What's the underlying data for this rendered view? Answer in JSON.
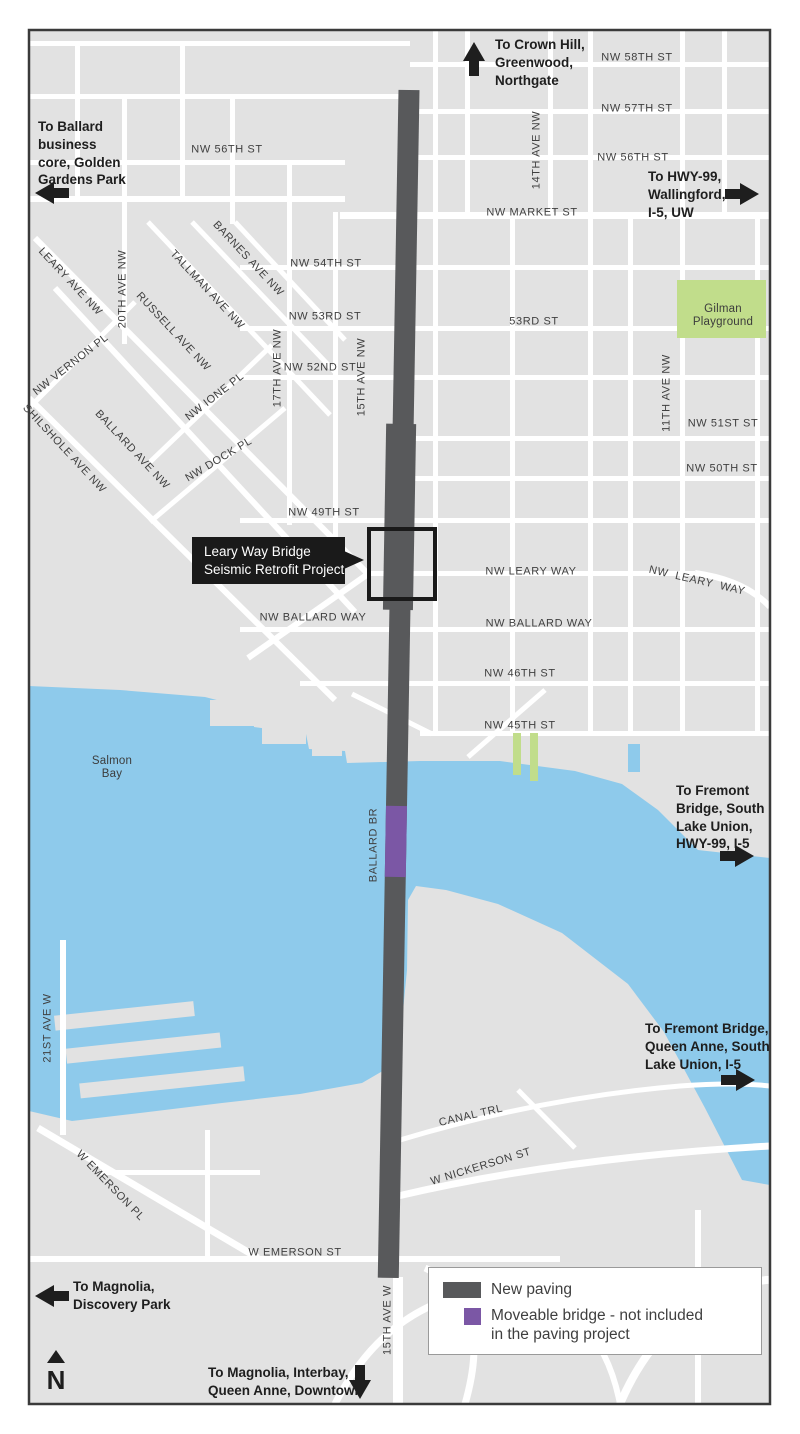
{
  "colors": {
    "land": "#e2e2e2",
    "street": "#ffffff",
    "water": "#8ecaeb",
    "park": "#c1dd8b",
    "paving": "#58595b",
    "moveable_bridge": "#7b57a5"
  },
  "callout": {
    "text": "Leary Way Bridge\nSeismic Retrofit Project"
  },
  "compass": {
    "label": "N"
  },
  "legend": {
    "items": [
      {
        "label": "New paving",
        "color": "#58595b"
      },
      {
        "label": "Moveable bridge - not included\nin the paving project",
        "color": "#7b57a5"
      }
    ]
  },
  "direction_signs": [
    {
      "text": "To Crown Hill,\nGreenwood,\nNorthgate",
      "tx": 495,
      "ty": 36,
      "arrow": {
        "dir": "up",
        "x": 474,
        "y": 59
      }
    },
    {
      "text": "To Ballard\nbusiness\ncore, Golden\nGardens Park",
      "tx": 38,
      "ty": 118,
      "arrow": {
        "dir": "left",
        "x": 52,
        "y": 193
      }
    },
    {
      "text": "To HWY-99,\nWallingford,\nI-5, UW",
      "tx": 648,
      "ty": 168,
      "arrow": {
        "dir": "right",
        "x": 742,
        "y": 194
      }
    },
    {
      "text": "To Fremont\nBridge, South\nLake Union,\nHWY-99, I-5",
      "tx": 676,
      "ty": 782,
      "arrow": {
        "dir": "right",
        "x": 737,
        "y": 856
      }
    },
    {
      "text": "To Fremont Bridge,\nQueen Anne, South\nLake Union, I-5",
      "tx": 645,
      "ty": 1020,
      "arrow": {
        "dir": "right",
        "x": 738,
        "y": 1080
      }
    },
    {
      "text": "To Magnolia,\nDiscovery Park",
      "tx": 73,
      "ty": 1278,
      "arrow": {
        "dir": "left",
        "x": 52,
        "y": 1296
      }
    },
    {
      "text": "To Magnolia, Interbay,\nQueen Anne, Downtown",
      "tx": 208,
      "ty": 1364,
      "arrow": {
        "dir": "down",
        "x": 360,
        "y": 1382
      }
    }
  ],
  "map_labels": [
    {
      "text": "NW 58TH ST",
      "x": 637,
      "y": 58,
      "rot": 0
    },
    {
      "text": "NW 57TH ST",
      "x": 637,
      "y": 109,
      "rot": 0
    },
    {
      "text": "NW 56TH ST",
      "x": 633,
      "y": 158,
      "rot": 0
    },
    {
      "text": "NW 56TH ST",
      "x": 227,
      "y": 150,
      "rot": 0
    },
    {
      "text": "NW MARKET ST",
      "x": 532,
      "y": 213,
      "rot": 0
    },
    {
      "text": "14TH AVE NW",
      "x": 537,
      "y": 150,
      "rot": -90
    },
    {
      "text": "NW 54TH ST",
      "x": 326,
      "y": 264,
      "rot": 0
    },
    {
      "text": "NW 53RD ST",
      "x": 325,
      "y": 317,
      "rot": 0
    },
    {
      "text": "53RD ST",
      "x": 534,
      "y": 322,
      "rot": 0
    },
    {
      "text": "NW 52ND ST",
      "x": 320,
      "y": 368,
      "rot": 0
    },
    {
      "text": "17TH AVE NW",
      "x": 278,
      "y": 368,
      "rot": -90
    },
    {
      "text": "15TH AVE NW",
      "x": 362,
      "y": 377,
      "rot": -90
    },
    {
      "text": "11TH AVE NW",
      "x": 667,
      "y": 393,
      "rot": -90
    },
    {
      "text": "NW 51ST ST",
      "x": 723,
      "y": 424,
      "rot": 0
    },
    {
      "text": "NW 50TH ST",
      "x": 722,
      "y": 469,
      "rot": 0
    },
    {
      "text": "NW 49TH ST",
      "x": 324,
      "y": 513,
      "rot": 0
    },
    {
      "text": "NW LEARY WAY",
      "x": 531,
      "y": 572,
      "rot": 0
    },
    {
      "text": "NW  LEARY  WAY",
      "x": 697,
      "y": 581,
      "rot": 13
    },
    {
      "text": "NW BALLARD WAY",
      "x": 313,
      "y": 618,
      "rot": 0
    },
    {
      "text": "NW BALLARD WAY",
      "x": 539,
      "y": 624,
      "rot": 0
    },
    {
      "text": "NW 46TH ST",
      "x": 520,
      "y": 674,
      "rot": 0
    },
    {
      "text": "NW 45TH ST",
      "x": 520,
      "y": 726,
      "rot": 0
    },
    {
      "text": "LEARY AVE NW",
      "x": 70,
      "y": 282,
      "rot": 47
    },
    {
      "text": "20TH AVE NW",
      "x": 123,
      "y": 289,
      "rot": -90
    },
    {
      "text": "RUSSELL AVE NW",
      "x": 173,
      "y": 332,
      "rot": 47
    },
    {
      "text": "TALLMAN AVE NW",
      "x": 207,
      "y": 290,
      "rot": 47
    },
    {
      "text": "BARNES AVE NW",
      "x": 248,
      "y": 259,
      "rot": 47
    },
    {
      "text": "NW VERNON PL",
      "x": 71,
      "y": 365,
      "rot": -38
    },
    {
      "text": "NW IONE PL",
      "x": 215,
      "y": 397,
      "rot": -38
    },
    {
      "text": "NW DOCK PL",
      "x": 219,
      "y": 460,
      "rot": -31
    },
    {
      "text": "BALLARD AVE NW",
      "x": 132,
      "y": 450,
      "rot": 47
    },
    {
      "text": "SHILSHOLE AVE NW",
      "x": 64,
      "y": 449,
      "rot": 47
    },
    {
      "text": "Gilman\nPlayground",
      "x": 723,
      "y": 316,
      "rot": 0,
      "cls": "place"
    },
    {
      "text": "Salmon\nBay",
      "x": 112,
      "y": 768,
      "rot": 0,
      "cls": "place"
    },
    {
      "text": "BALLARD BR",
      "x": 374,
      "y": 845,
      "rot": -90
    },
    {
      "text": "21ST AVE W",
      "x": 48,
      "y": 1028,
      "rot": -90
    },
    {
      "text": "W EMERSON PL",
      "x": 110,
      "y": 1186,
      "rot": 46
    },
    {
      "text": "CANAL TRL",
      "x": 471,
      "y": 1116,
      "rot": -13
    },
    {
      "text": "W NICKERSON ST",
      "x": 481,
      "y": 1167,
      "rot": -17
    },
    {
      "text": "W EMERSON ST",
      "x": 295,
      "y": 1253,
      "rot": 0
    },
    {
      "text": "15TH AVE W",
      "x": 388,
      "y": 1320,
      "rot": -90
    }
  ]
}
